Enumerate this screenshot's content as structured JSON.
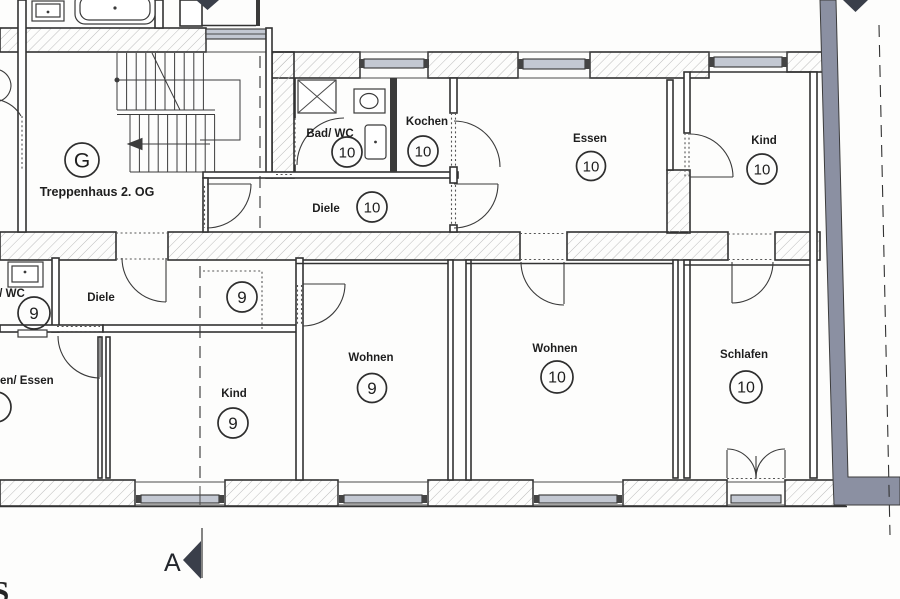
{
  "plan": {
    "rooms": [
      {
        "name": "Treppenhaus 2. OG",
        "number": "G"
      },
      {
        "name": "Bad/ WC",
        "number": "10"
      },
      {
        "name": "Kochen",
        "number": "10"
      },
      {
        "name": "Diele",
        "number": "10"
      },
      {
        "name": "Essen",
        "number": "10"
      },
      {
        "name": "Kind",
        "number": "10"
      },
      {
        "name": "/ WC",
        "number": "9"
      },
      {
        "name": "Diele",
        "number": "9"
      },
      {
        "name": "en/ Essen",
        "number": ""
      },
      {
        "name": "Kind",
        "number": "9"
      },
      {
        "name": "Wohnen",
        "number": "9"
      },
      {
        "name": "Wohnen",
        "number": "10"
      },
      {
        "name": "Schlafen",
        "number": "10"
      }
    ],
    "section_marker": {
      "label": "A"
    },
    "edge_text": {
      "bottom_left_partial": "S"
    },
    "colors": {
      "party_wall_gray": "#8b90a2",
      "marker_dark": "#3a3f4a",
      "window_fill": "#c3c8d2"
    }
  }
}
